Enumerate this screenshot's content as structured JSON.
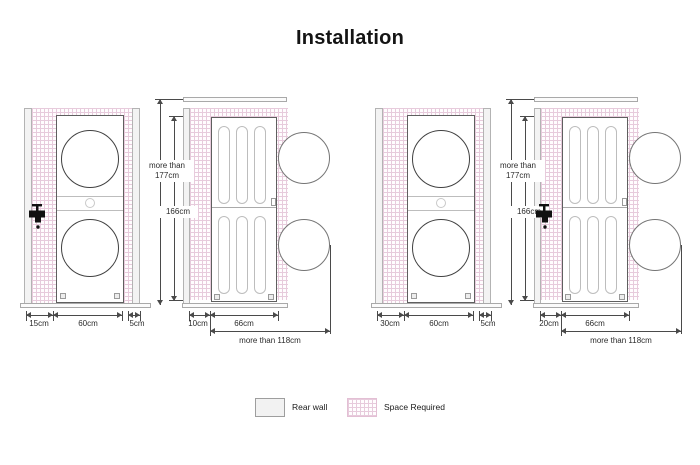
{
  "title": "Installation",
  "legend": {
    "rear_wall_label": "Rear wall",
    "space_required_label": "Space Required"
  },
  "colors": {
    "space_required_pink": "#e7cbdc",
    "rear_wall_gray": "#f2f2f2",
    "outline_gray": "#9e9e9e",
    "unit_outline": "#5f5f5f",
    "dimension_line": "#4a4a4a",
    "faucet_black": "#111111"
  },
  "installations": {
    "side_wall_faucet": {
      "front": {
        "left_gap": "15cm",
        "unit_width": "60cm",
        "right_gap": "5cm"
      },
      "side": {
        "ceiling_line1": "more than",
        "ceiling_line2": "177cm",
        "unit_height": "166cm",
        "rear_gap": "10cm",
        "unit_depth": "66cm",
        "front_clearance": "more than 118cm"
      }
    },
    "rear_wall_faucet": {
      "front": {
        "left_gap": "30cm",
        "unit_width": "60cm",
        "right_gap": "5cm"
      },
      "side": {
        "ceiling_line1": "more than",
        "ceiling_line2": "177cm",
        "unit_height": "166cm",
        "rear_gap": "20cm",
        "unit_depth": "66cm",
        "front_clearance": "more than 118cm"
      }
    }
  }
}
